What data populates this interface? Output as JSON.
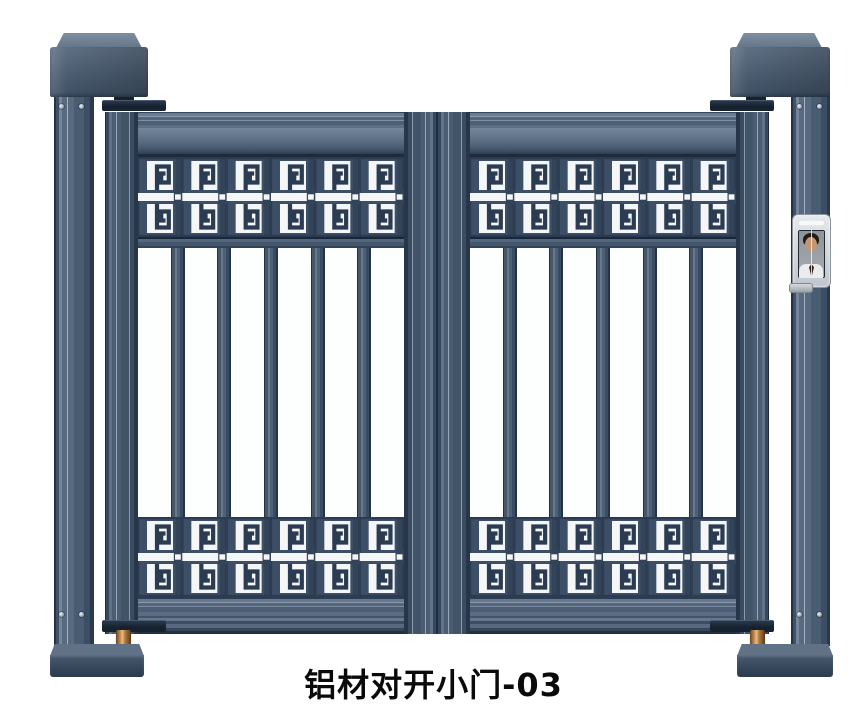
{
  "product": {
    "caption": "铝材对开小门-03"
  },
  "colors": {
    "background": "#ffffff",
    "metal_main": "#4d5e72",
    "metal_light": "#98a6b6",
    "metal_dark": "#22324a",
    "pattern_tile": "#3d4f66",
    "pattern_groove": "#2b3b51",
    "pattern_separator": "#334458",
    "pattern_white": "#f4f6f8",
    "copper": "#c99055",
    "device_frame": "#ccd2d8",
    "device_screen": "#23282f",
    "caption_color": "#0a0a0a"
  },
  "structure": {
    "posts": 2,
    "panels": 2,
    "bands_per_panel": 2,
    "meander_units_per_band": 6,
    "vertical_bars_per_panel": 5,
    "bar_slots_per_panel": 6,
    "screws_per_post": 4
  }
}
